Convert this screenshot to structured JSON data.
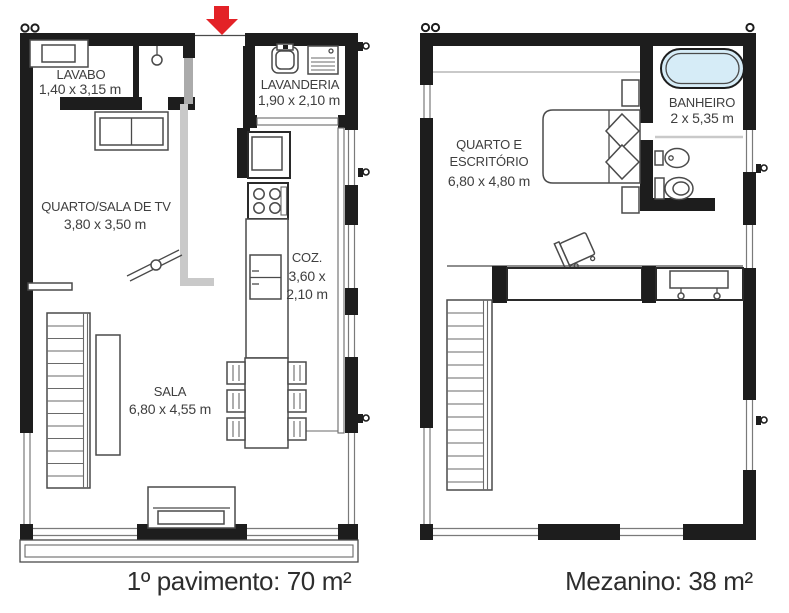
{
  "colors": {
    "wall": "#1d1d1d",
    "furniture_line": "#4a4a4a",
    "light_line": "#c9c9c9",
    "door_panel": "#ababab",
    "arrow_red": "#e32227",
    "tub_fill": "#d6ecf7",
    "label_text": "#3f3f3f",
    "caption_text": "#2d2d2d"
  },
  "first_floor": {
    "caption": "1º pavimento: 70 m²",
    "entrance_marker": "red-arrow-down",
    "rooms": {
      "lavabo": {
        "name": "LAVABO",
        "dims": "1,40 x 3,15 m"
      },
      "quarto_sala_tv": {
        "name": "QUARTO/SALA DE TV",
        "dims": "3,80 x 3,50 m"
      },
      "lavanderia": {
        "name": "LAVANDERIA",
        "dims": "1,90 x 2,10 m"
      },
      "cozinha": {
        "name": "COZ.",
        "dims_line1": "3,60 x",
        "dims_line2": "2,10 m"
      },
      "sala": {
        "name": "SALA",
        "dims": "6,80 x 4,55 m"
      }
    }
  },
  "mezzanine": {
    "caption": "Mezanino: 38 m²",
    "rooms": {
      "quarto_escritorio": {
        "name_line1": "QUARTO E",
        "name_line2": "ESCRITÓRIO",
        "dims": "6,80 x 4,80 m"
      },
      "banheiro": {
        "name": "BANHEIRO",
        "dims": "2 x 5,35 m"
      }
    }
  }
}
